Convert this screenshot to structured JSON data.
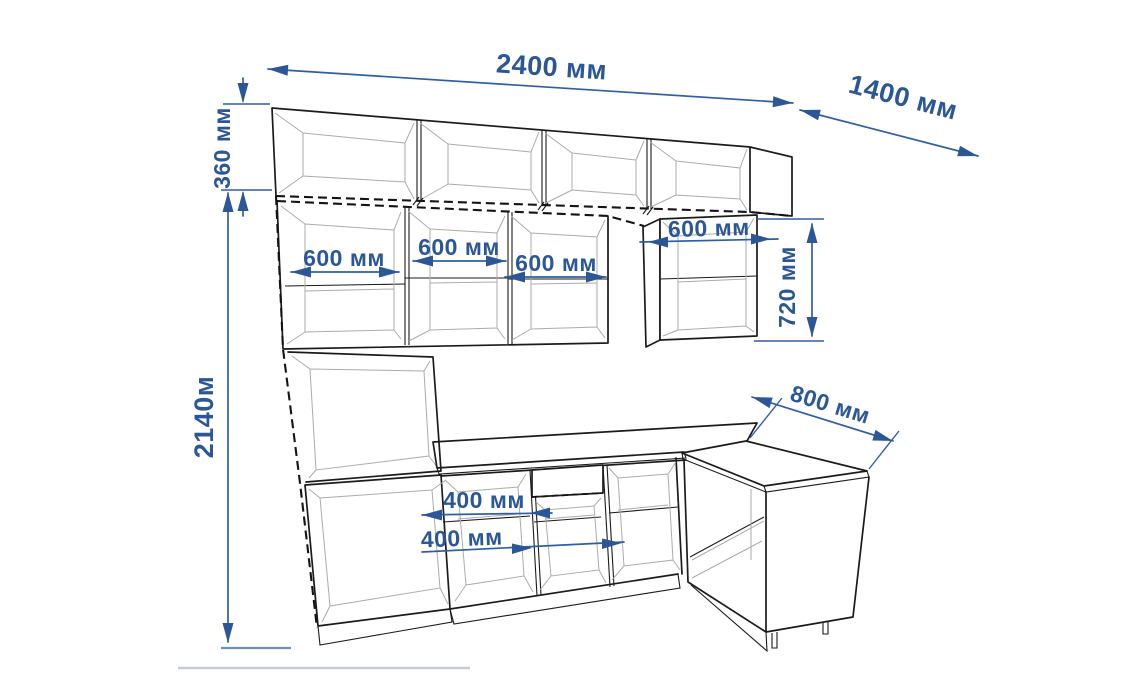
{
  "diagram": {
    "type": "kitchen-cabinet-dimension-drawing",
    "units": "мм"
  },
  "colors": {
    "dimension": "#2b5797",
    "dimension_line": "#2e5fa5",
    "outline": "#1b1b1b",
    "interior": "#ababab",
    "floor_line": "#c3cdd9"
  },
  "dimensions": [
    {
      "id": "total-width",
      "label": "2400 мм"
    },
    {
      "id": "right-depth",
      "label": "1400 мм"
    },
    {
      "id": "upper-row-height",
      "label": "360 мм"
    },
    {
      "id": "total-height",
      "label": "2140м"
    },
    {
      "id": "wall-cabinet-1-width",
      "label": "600 мм"
    },
    {
      "id": "wall-cabinet-2-width",
      "label": "600 мм"
    },
    {
      "id": "wall-cabinet-3-width",
      "label": "600 мм"
    },
    {
      "id": "wall-cabinet-4-width",
      "label": "600 мм"
    },
    {
      "id": "wall-cabinet-height",
      "label": "720 мм"
    },
    {
      "id": "peninsula-length",
      "label": "800 мм"
    },
    {
      "id": "base-cabinet-1-width",
      "label": "400 мм"
    },
    {
      "id": "base-cabinet-2-width",
      "label": "400 мм"
    }
  ]
}
